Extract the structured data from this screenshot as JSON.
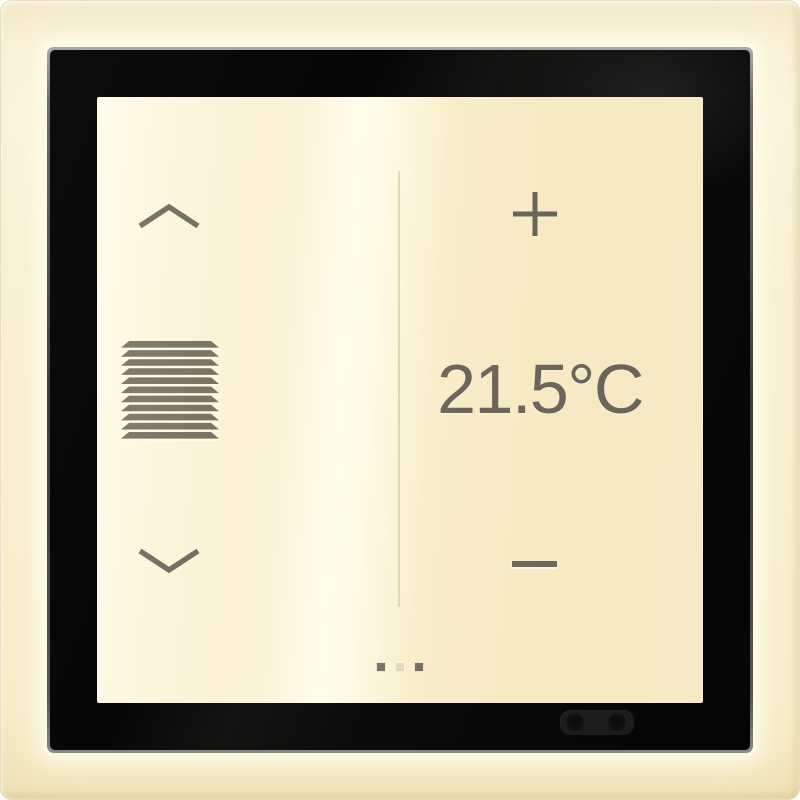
{
  "device": {
    "type": "touch room controller panel",
    "temperature_display": {
      "value": "21.5°C"
    },
    "blinds_zone": {
      "up_icon": "chevron-up-icon",
      "center_icon": "blinds-shutter-icon",
      "down_icon": "chevron-down-icon"
    },
    "temperature_zone": {
      "increase_icon": "plus-icon",
      "decrease_icon": "minus-icon"
    },
    "page_indicator": {
      "count": 3,
      "dots": [
        {
          "index": 1,
          "style": "dark"
        },
        {
          "index": 2,
          "style": "light"
        },
        {
          "index": 3,
          "style": "dark"
        }
      ]
    },
    "hardware": {
      "sensor_window": "proximity-ir-sensor"
    },
    "colors": {
      "frame": "#f8eecb",
      "bezel": "#0a0a0a",
      "screen": "#fcf3d4",
      "glyph": "#6f6a5c",
      "divider": "#e1d5ae",
      "dot_dark": "#766f5f",
      "dot_light": "#e4dbbd"
    }
  }
}
